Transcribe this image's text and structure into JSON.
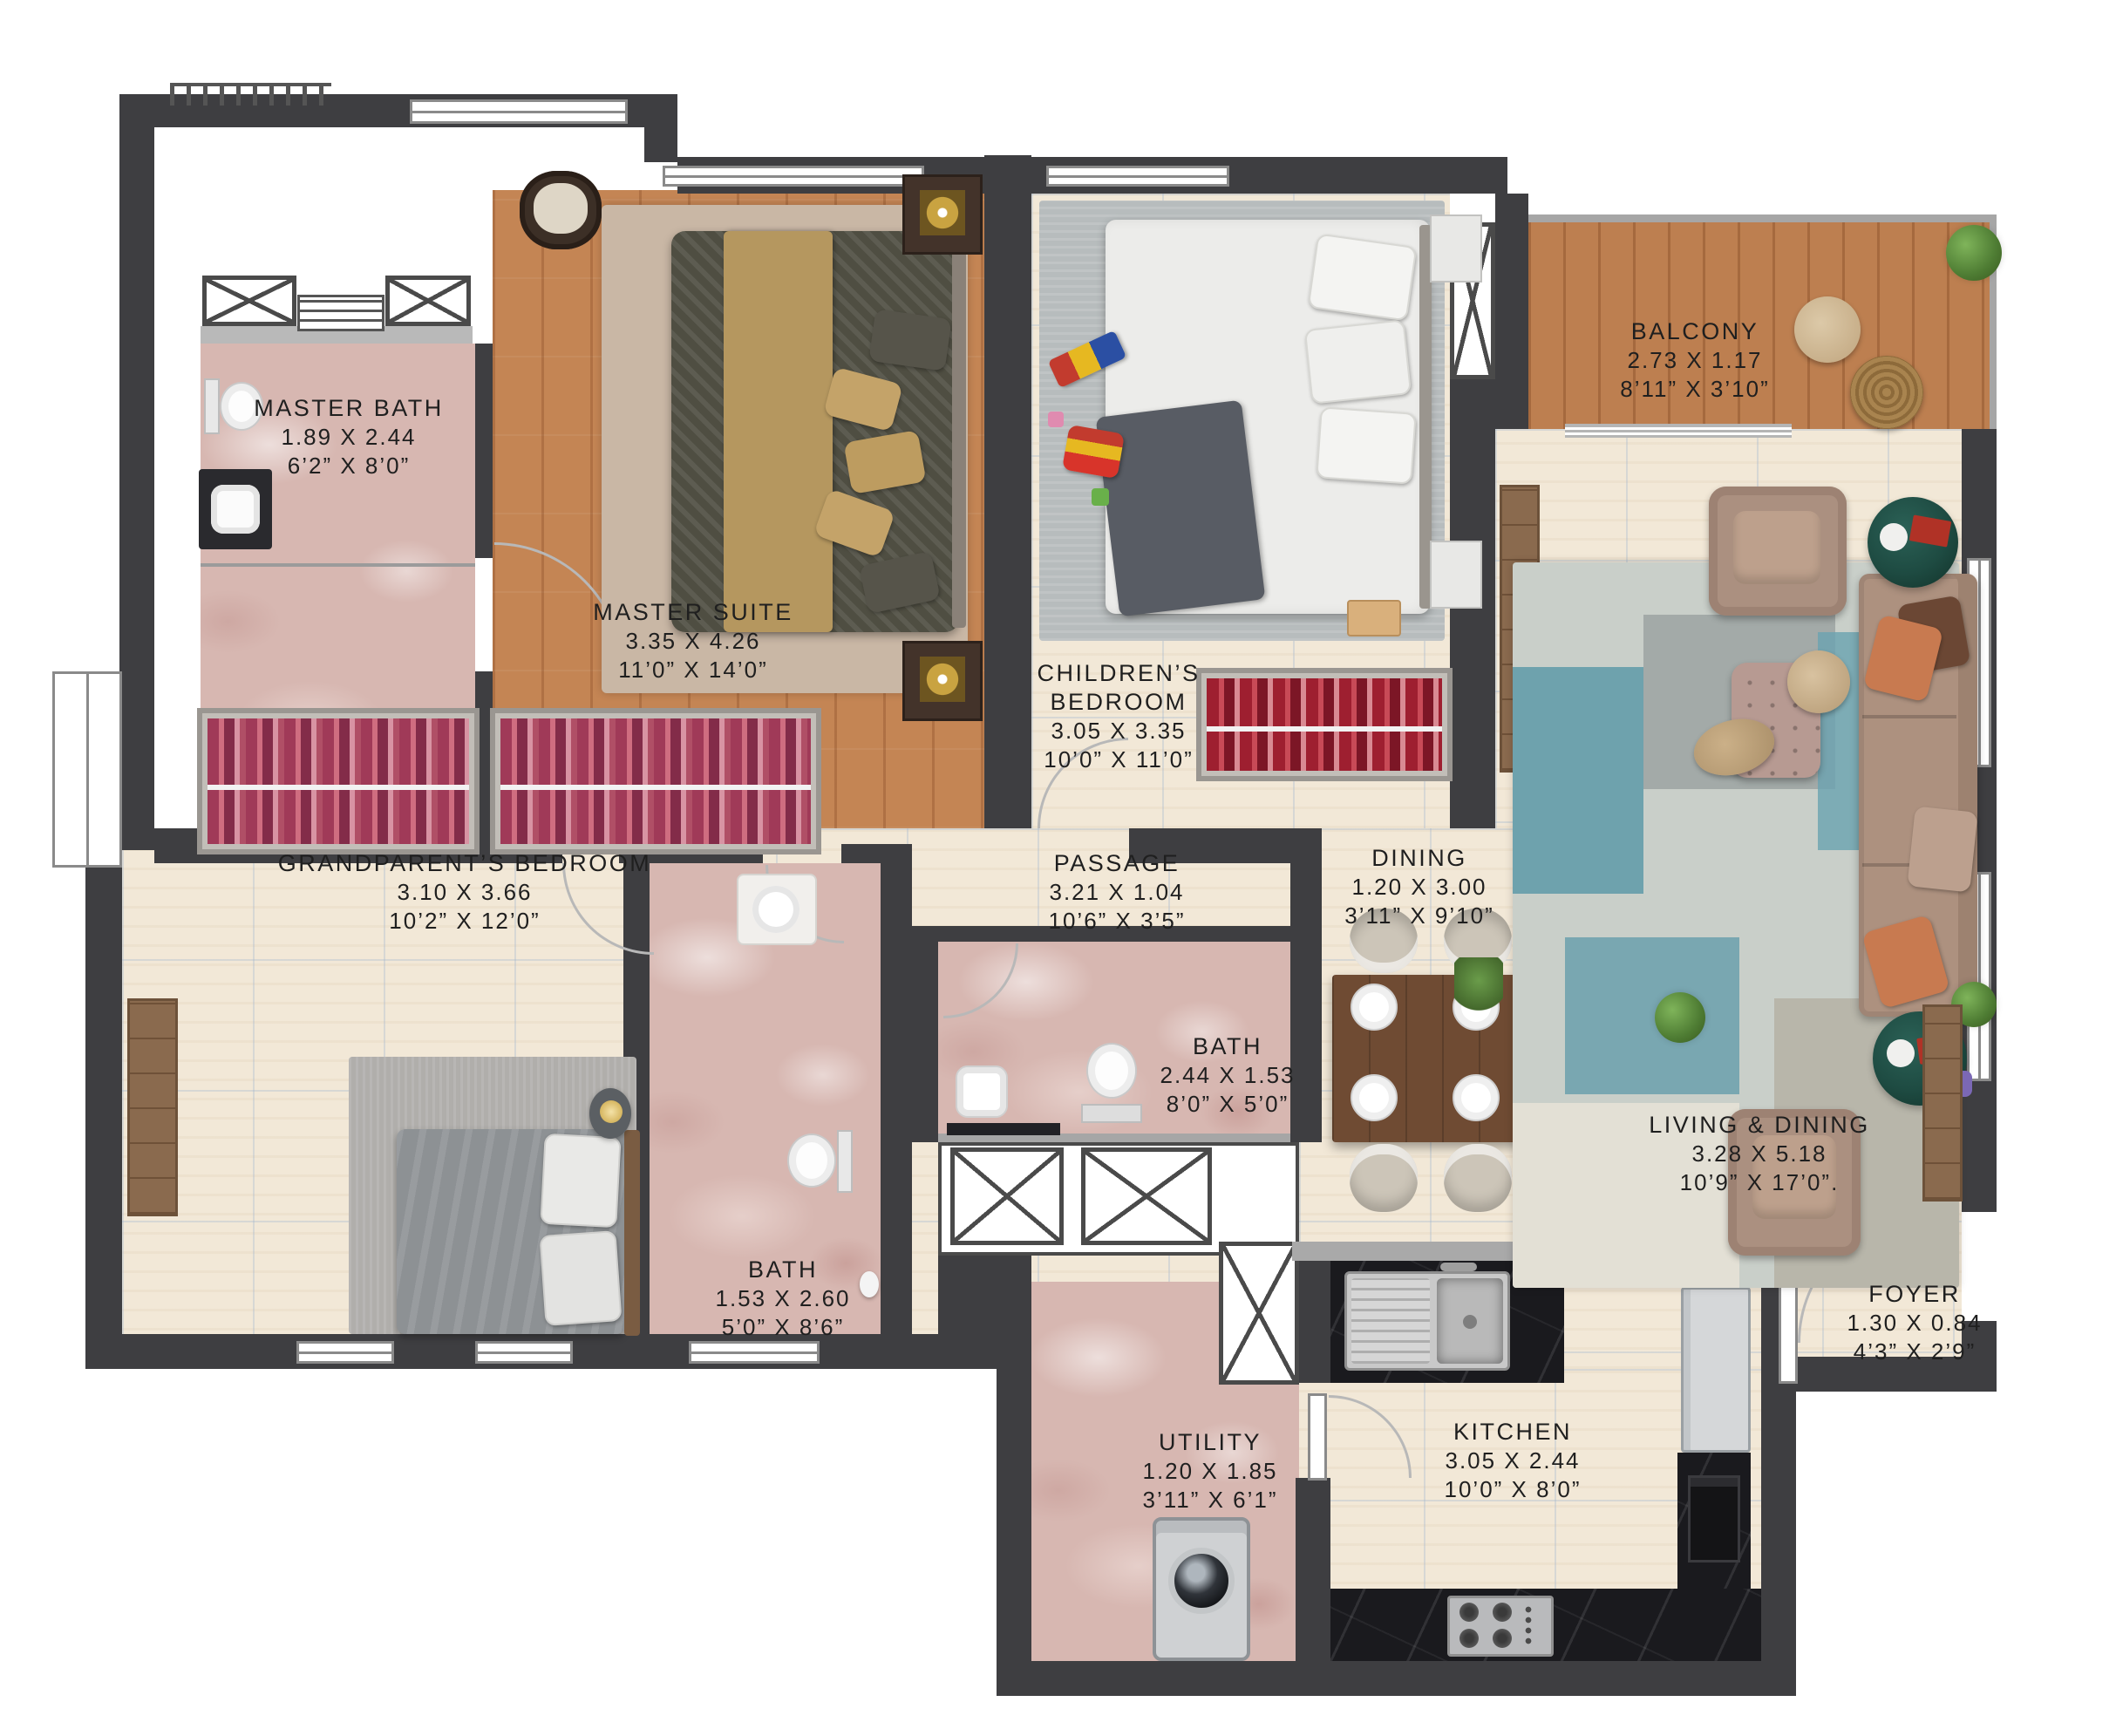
{
  "plan_type": "apartment-floor-plan",
  "rooms": [
    {
      "name": "MASTER BATH",
      "dim_m": "1.89 X 2.44",
      "dim_ft": "6’2” X 8’0”"
    },
    {
      "name": "MASTER SUITE",
      "dim_m": "3.35 X 4.26",
      "dim_ft": "11’0” X 14’0”"
    },
    {
      "name": "CHILDREN’S BEDROOM",
      "dim_m": "3.05 X 3.35",
      "dim_ft": "10’0” X 11’0”"
    },
    {
      "name": "BALCONY",
      "dim_m": "2.73 X 1.17",
      "dim_ft": "8’11” X 3’10”"
    },
    {
      "name": "GRANDPARENT’S BEDROOM",
      "dim_m": "3.10 X 3.66",
      "dim_ft": "10’2” X 12’0”"
    },
    {
      "name": "PASSAGE",
      "dim_m": "3.21 X 1.04",
      "dim_ft": "10’6” X 3’5”"
    },
    {
      "name": "DINING",
      "dim_m": "1.20 X 3.00",
      "dim_ft": "3’11” X 9’10”"
    },
    {
      "name": "BATH",
      "dim_m": "2.44 X 1.53",
      "dim_ft": "8’0” X 5’0”"
    },
    {
      "name": "BATH",
      "dim_m": "1.53 X 2.60",
      "dim_ft": "5’0” X 8’6”"
    },
    {
      "name": "LIVING & DINING",
      "dim_m": "3.28 X 5.18",
      "dim_ft": "10’9” X 17’0”."
    },
    {
      "name": "FOYER",
      "dim_m": "1.30 X 0.84",
      "dim_ft": "4’3” X 2’9”"
    },
    {
      "name": "UTILITY",
      "dim_m": "1.20 X 1.85",
      "dim_ft": "3’11” X 6’1”"
    },
    {
      "name": "KITCHEN",
      "dim_m": "3.05 X 2.44",
      "dim_ft": "10’0” X 8’0”"
    }
  ],
  "colors": {
    "wall": "#3e3e41",
    "tile_floor": "#f2e8d7",
    "wood_floor": "#c48554",
    "pink_marble": "#d7b7b1",
    "black_marble": "#1a1a1e",
    "label_text": "#1f1f1f"
  }
}
